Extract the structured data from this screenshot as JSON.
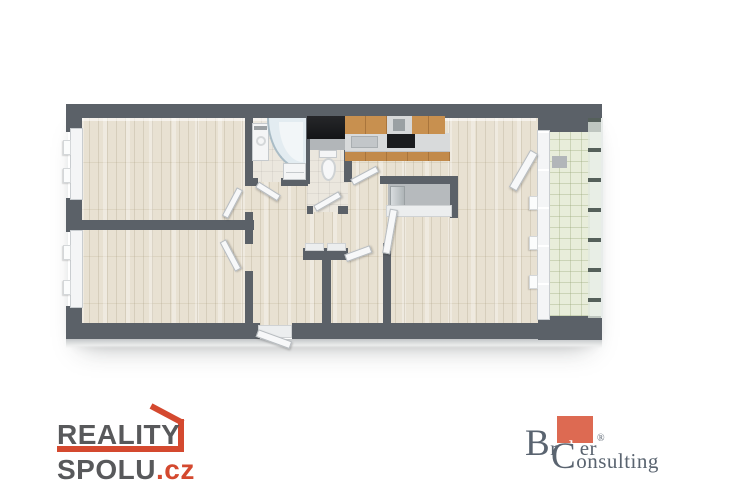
{
  "branding": {
    "reality": {
      "line1": "REALITY",
      "line2": "SPOLU",
      "tld": ".cz",
      "text_color": "#58595b",
      "accent_color": "#d4492f"
    },
    "broker": {
      "b": "B",
      "r": "r",
      "ok": "ok",
      "er": "er",
      "reg": "®",
      "c": "C",
      "onsulting": "onsulting",
      "text_color": "#5a6470",
      "accent_color": "#dd6a52"
    }
  },
  "floorplan": {
    "type": "apartment-floor-plan-3d-top-view",
    "rooms": [
      "bedroom-top-left",
      "bedroom-bottom-left",
      "hall",
      "bathroom",
      "wc",
      "kitchen",
      "living-room",
      "closet",
      "pantry-niche",
      "balcony"
    ],
    "fixtures": [
      "washing-machine",
      "corner-shower",
      "bathroom-vanity",
      "toilet",
      "kitchen-upper-cabinets",
      "cooker-hood",
      "kitchen-counter",
      "sink",
      "cooktop",
      "fridge",
      "balcony-bench",
      "balcony-railing",
      "entrance-door"
    ],
    "colors": {
      "wall": "#5b6168",
      "wood_floor": "#e8e1d2",
      "bath_tile": "#ebe7de",
      "balcony_tile": "#e8edda",
      "window_white": "#f4f5f6",
      "cabinet_wood": "#c28a4a",
      "counter_gray": "#d8dadb",
      "cooktop_black": "#1b1c1e"
    }
  }
}
